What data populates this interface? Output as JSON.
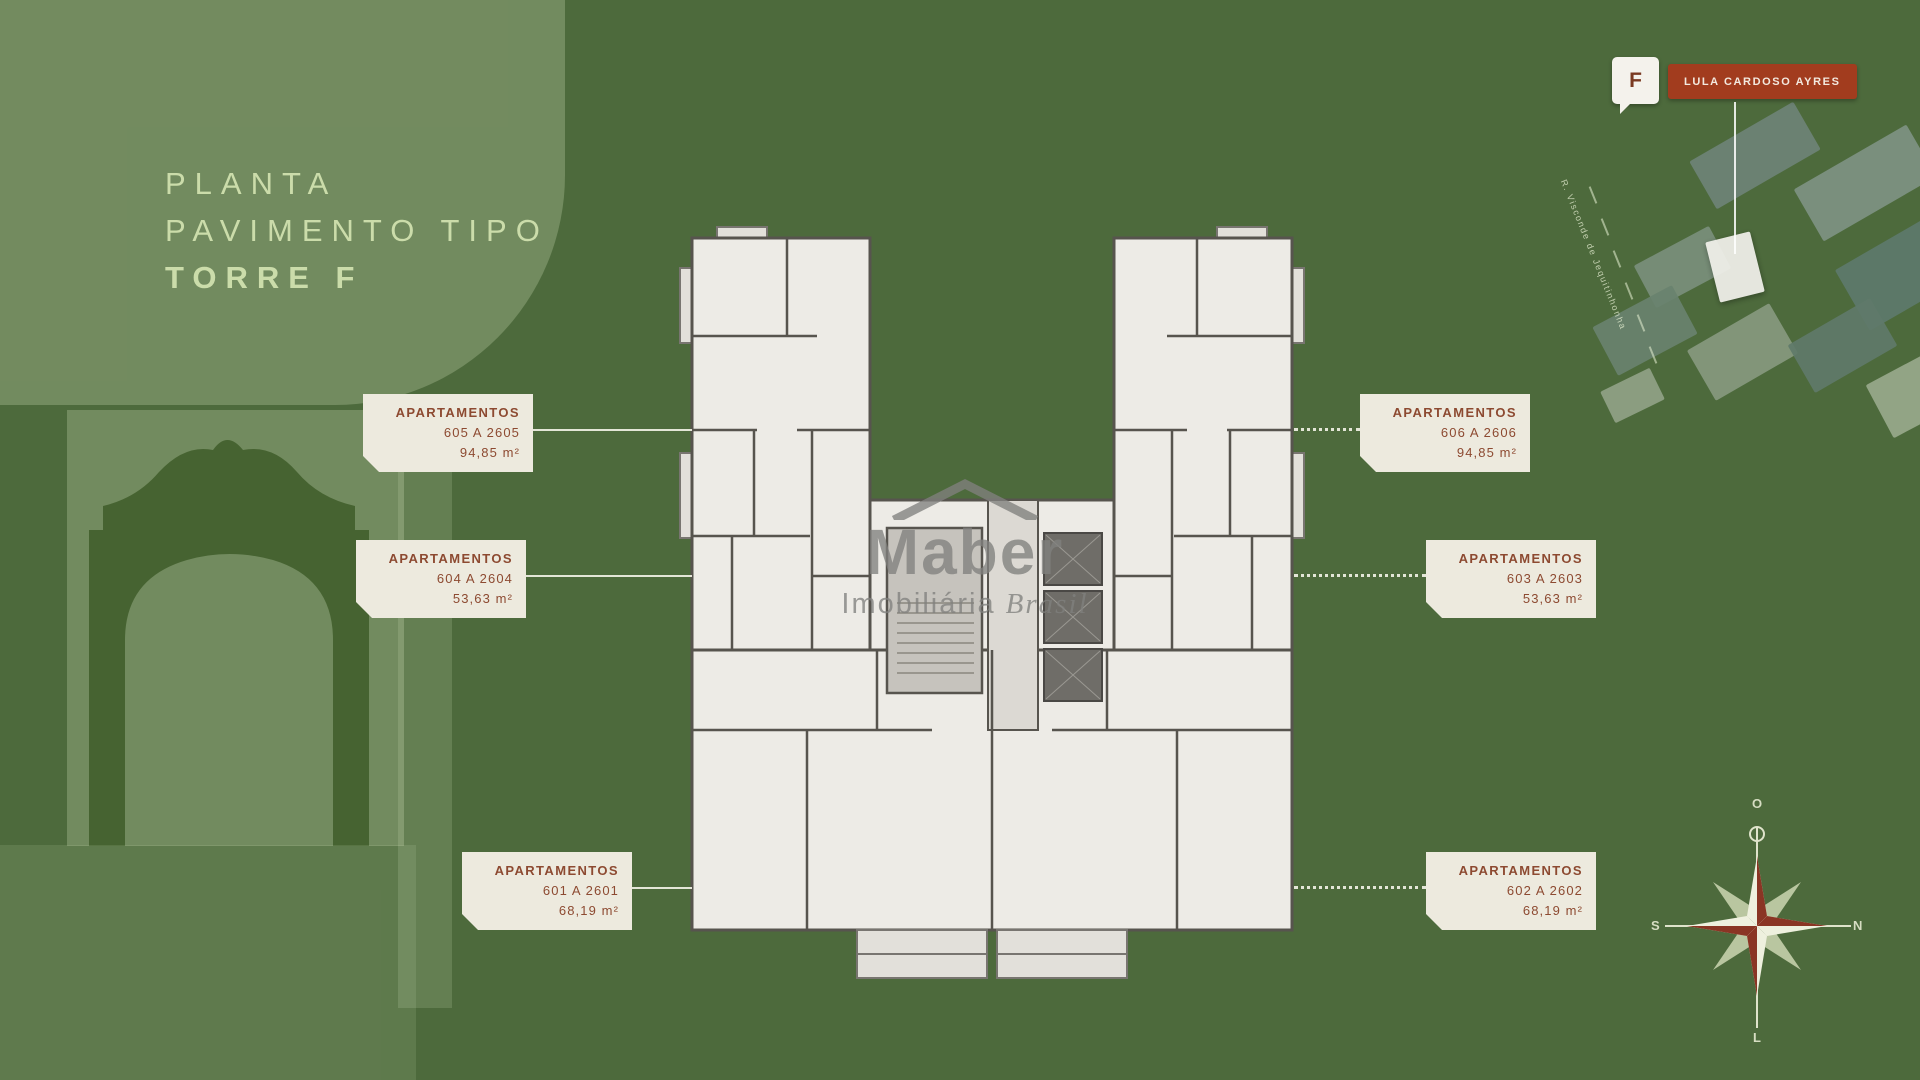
{
  "title": {
    "line1": "PLANTA",
    "line2": "PAVIMENTO TIPO",
    "line3": "TORRE F"
  },
  "callouts": [
    {
      "id": "top-left",
      "l1": "APARTAMENTOS",
      "l2": "605 A 2605",
      "l3": "94,85 m²"
    },
    {
      "id": "top-right",
      "l1": "APARTAMENTOS",
      "l2": "606 A 2606",
      "l3": "94,85 m²"
    },
    {
      "id": "mid-left",
      "l1": "APARTAMENTOS",
      "l2": "604 A 2604",
      "l3": "53,63 m²"
    },
    {
      "id": "mid-right",
      "l1": "APARTAMENTOS",
      "l2": "603 A 2603",
      "l3": "53,63 m²"
    },
    {
      "id": "bottom-left",
      "l1": "APARTAMENTOS",
      "l2": "601 A 2601",
      "l3": "68,19 m²"
    },
    {
      "id": "bottom-right",
      "l1": "APARTAMENTOS",
      "l2": "602 A 2602",
      "l3": "68,19 m²"
    }
  ],
  "pin": {
    "letter": "F",
    "banner_text": "LULA CARDOSO AYRES"
  },
  "site_map": {
    "street_label": "R. Visconde de Jequitinhonha"
  },
  "compass": {
    "top": "O",
    "right": "N",
    "bottom": "L",
    "left": "S"
  },
  "watermark": {
    "brand": "Maber",
    "tagline_word1": "Imobiliária",
    "tagline_word2": "Brasil"
  },
  "icons": {
    "pin_badge": "map-pin-badge",
    "compass": "compass-rose-icon",
    "watermark_roof": "house-roof-icon",
    "arch": "colonial-arch-silhouette"
  },
  "colors": {
    "background_green": "#4d6a3c",
    "light_overlay_green": "#7f9463",
    "title_text": "#cbdcaa",
    "callout_bg": "#edeade",
    "callout_text": "#8d4a31",
    "banner_red": "#a23c1e",
    "plan_wall": "#57544e",
    "plan_floor": "#edebe6",
    "watermark_gray": "#80807d"
  }
}
